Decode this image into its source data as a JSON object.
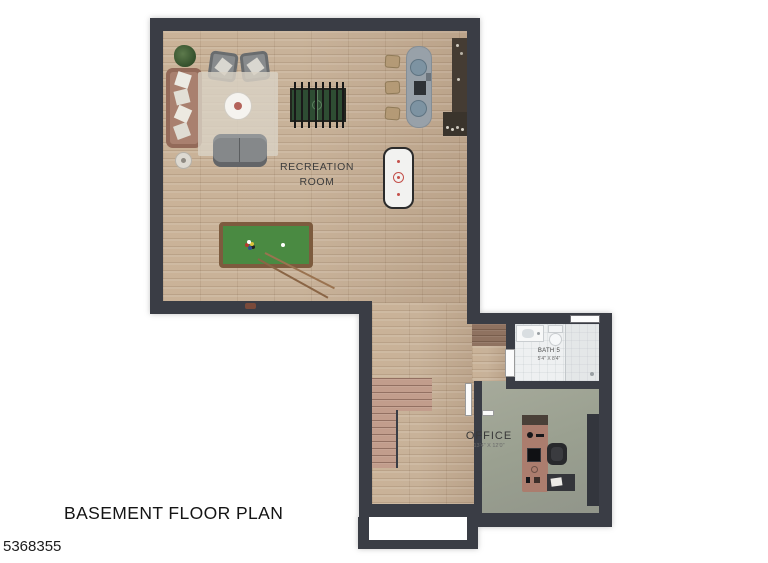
{
  "plan": {
    "title": "BASEMENT FLOOR PLAN",
    "listing_id": "5368355",
    "rooms": {
      "recreation": {
        "label": "RECREATION\nROOM"
      },
      "bath": {
        "label": "BATH 5",
        "dims": "5'4\" X 8'4\""
      },
      "office": {
        "label": "OFFICE",
        "dims": "13'4\" X 12'0\""
      }
    },
    "colors": {
      "wall": "#3a3d45",
      "wood_floor": "#c8b299",
      "stair_wood": "#c29d8c",
      "concrete_floor": "#9aa090",
      "tile_floor": "#eef0f1",
      "pool_felt": "#4a8a42",
      "pool_rim": "#7d5b3e",
      "foosball_felt": "#2e4d33",
      "desk": "#ab7d6e",
      "bar_counter": "#98a1a9",
      "sofa": "#a9806f",
      "gray_seat": "#888b8d",
      "rug": "#d9d2c4",
      "stool": "#b49a76"
    }
  }
}
